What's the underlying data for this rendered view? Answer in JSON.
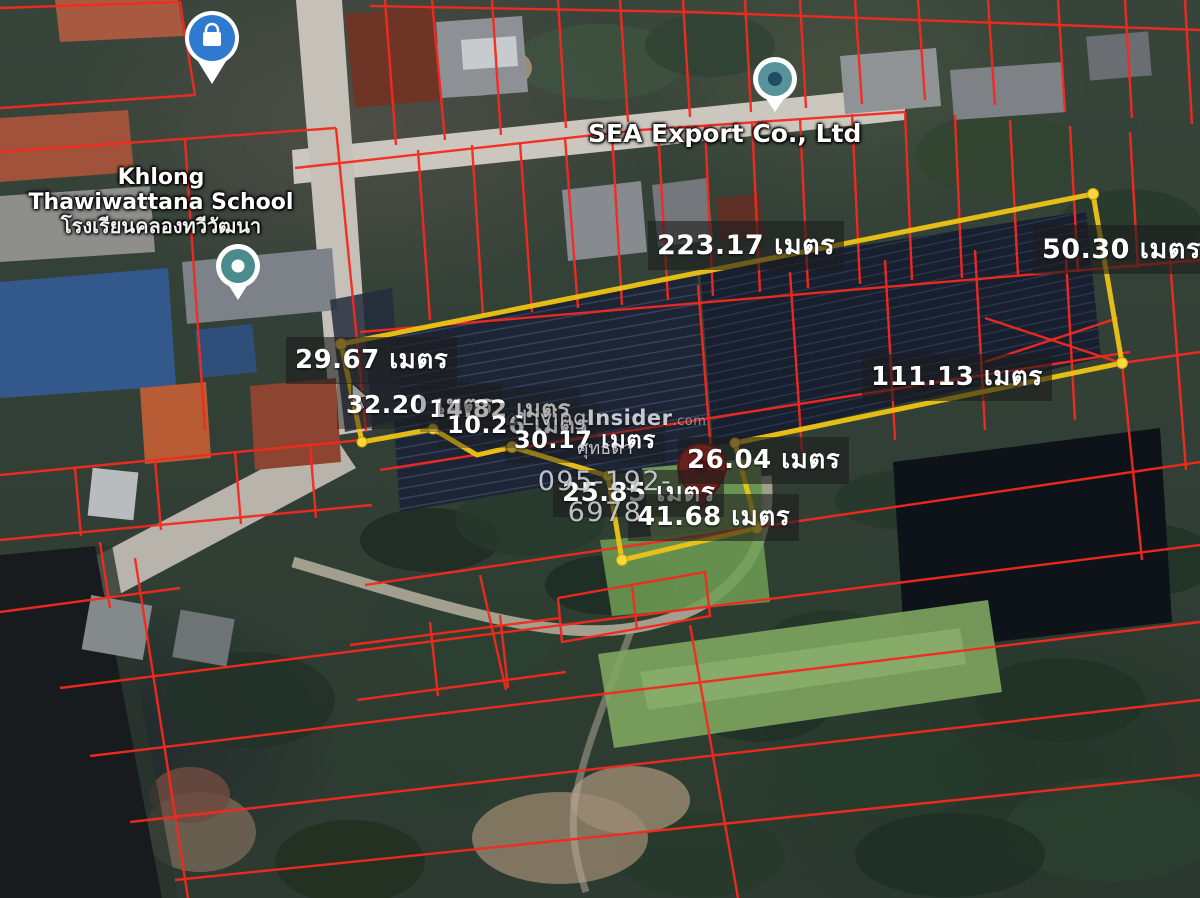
{
  "map": {
    "school": {
      "line1": "Khlong",
      "line2": "Thawiwattana School",
      "line3_thai": "โรงเรียนคลองทวีวัฒนา"
    },
    "company": "SEA Export Co., Ltd"
  },
  "measurements": {
    "top": "223.17 เมตร",
    "right": "50.30 เมตร",
    "frontage": "29.67 เมตร",
    "side_32": "32.20 เมตร",
    "side_14": "14.82 เมตร",
    "side_10": "10.26 เมตร",
    "side_30": "30.17 เมตร",
    "bottom": "111.13 เมตร",
    "plot2_top": "26.04 เมตร",
    "plot2_left": "25.85 เมตร",
    "plot2_bottom": "41.68 เมตร"
  },
  "watermark": {
    "brand_prefix": "Living",
    "brand_bold": "Insider",
    "brand_suffix": ".com",
    "agent_name": "ศุทธดา",
    "phone": "095-192-6978"
  },
  "colors": {
    "parcel_line": "#f5291f",
    "property_outline": "#eec414",
    "label_background": "rgba(28,28,28,0.60)",
    "pin_red": "#d92a20",
    "pin_blue": "#2e7ad1",
    "pin_teal": "#4b8b8b"
  }
}
